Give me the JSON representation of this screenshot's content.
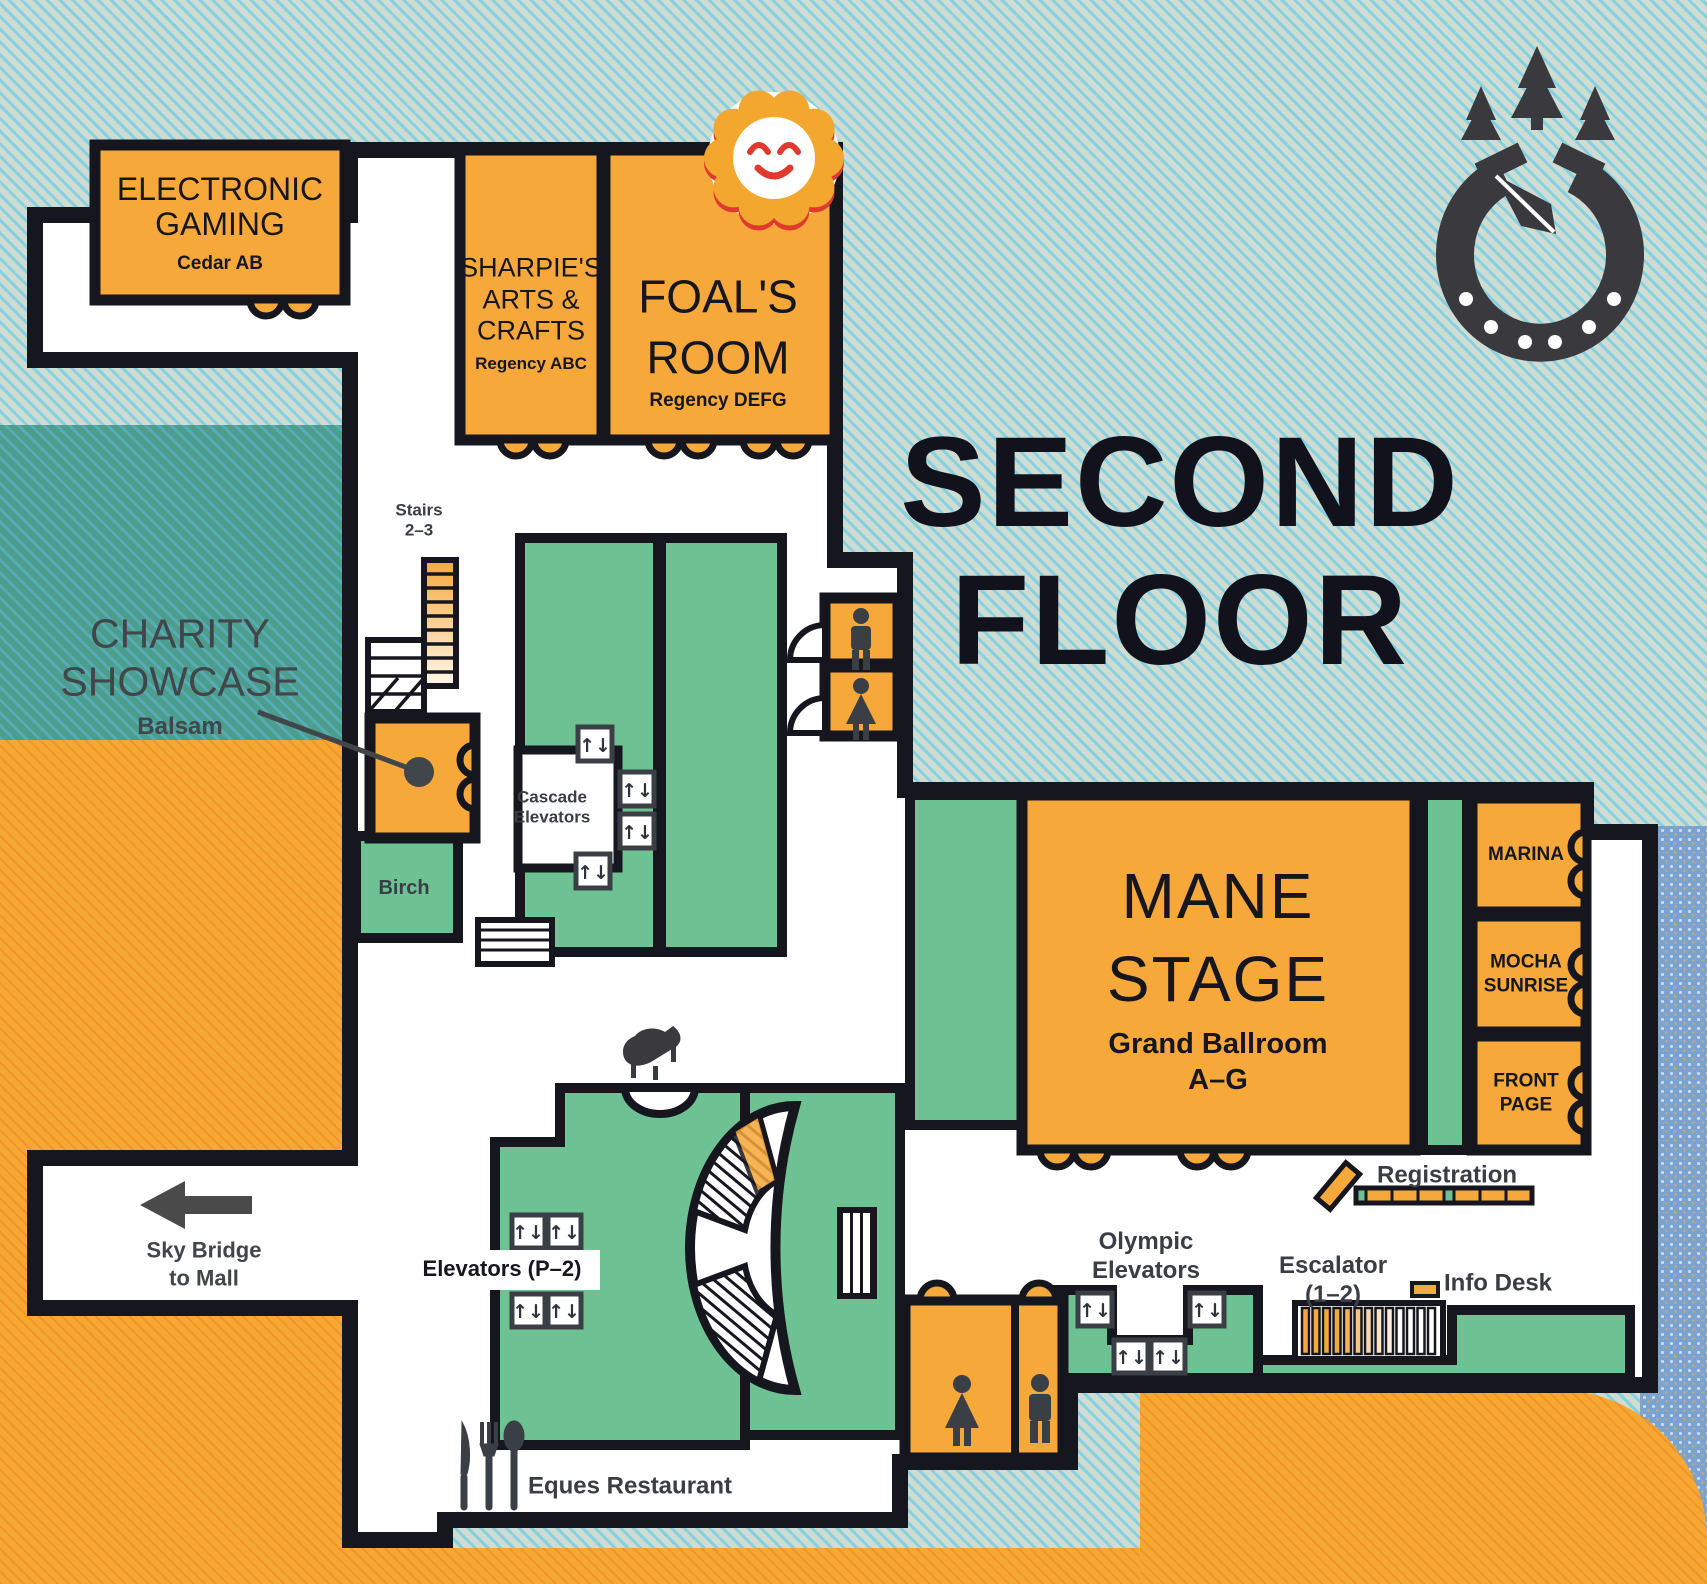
{
  "title": "SECOND\nFLOOR",
  "rooms": {
    "electronic_gaming": {
      "name": "ELECTRONIC\nGAMING",
      "sub": "Cedar AB"
    },
    "sharpies": {
      "name": "SHARPIE'S\nARTS &\nCRAFTS",
      "sub": "Regency ABC"
    },
    "foals": {
      "name": "FOAL'S\nROOM",
      "sub": "Regency DEFG"
    },
    "charity": {
      "name": "CHARITY\nSHOWCASE",
      "sub": "Balsam"
    },
    "mane": {
      "name": "MANE\nSTAGE",
      "sub": "Grand Ballroom\nA–G"
    },
    "marina": {
      "name": "MARINA"
    },
    "mocha": {
      "name": "MOCHA\nSUNRISE"
    },
    "front_page": {
      "name": "FRONT\nPAGE"
    },
    "birch": {
      "name": "Birch"
    }
  },
  "labels": {
    "stairs": "Stairs\n2–3",
    "cascade": "Cascade\nElevators",
    "olympic": "Olympic\nElevators",
    "escalator": "Escalator\n(1–2)",
    "registration": "Registration",
    "info_desk": "Info Desk",
    "sky_bridge": "Sky Bridge\nto Mall",
    "elevators_p2": "Elevators (P–2)",
    "eques": "Eques Restaurant"
  },
  "icons": {
    "elevator_glyph": "↑↓"
  },
  "colors": {
    "room_orange": "#F6A83A",
    "room_green": "#6EC192",
    "outline": "#16161E",
    "label_gray": "#41464A",
    "logo_gray": "#3A3A3E",
    "sun_red": "#E03A2F"
  }
}
